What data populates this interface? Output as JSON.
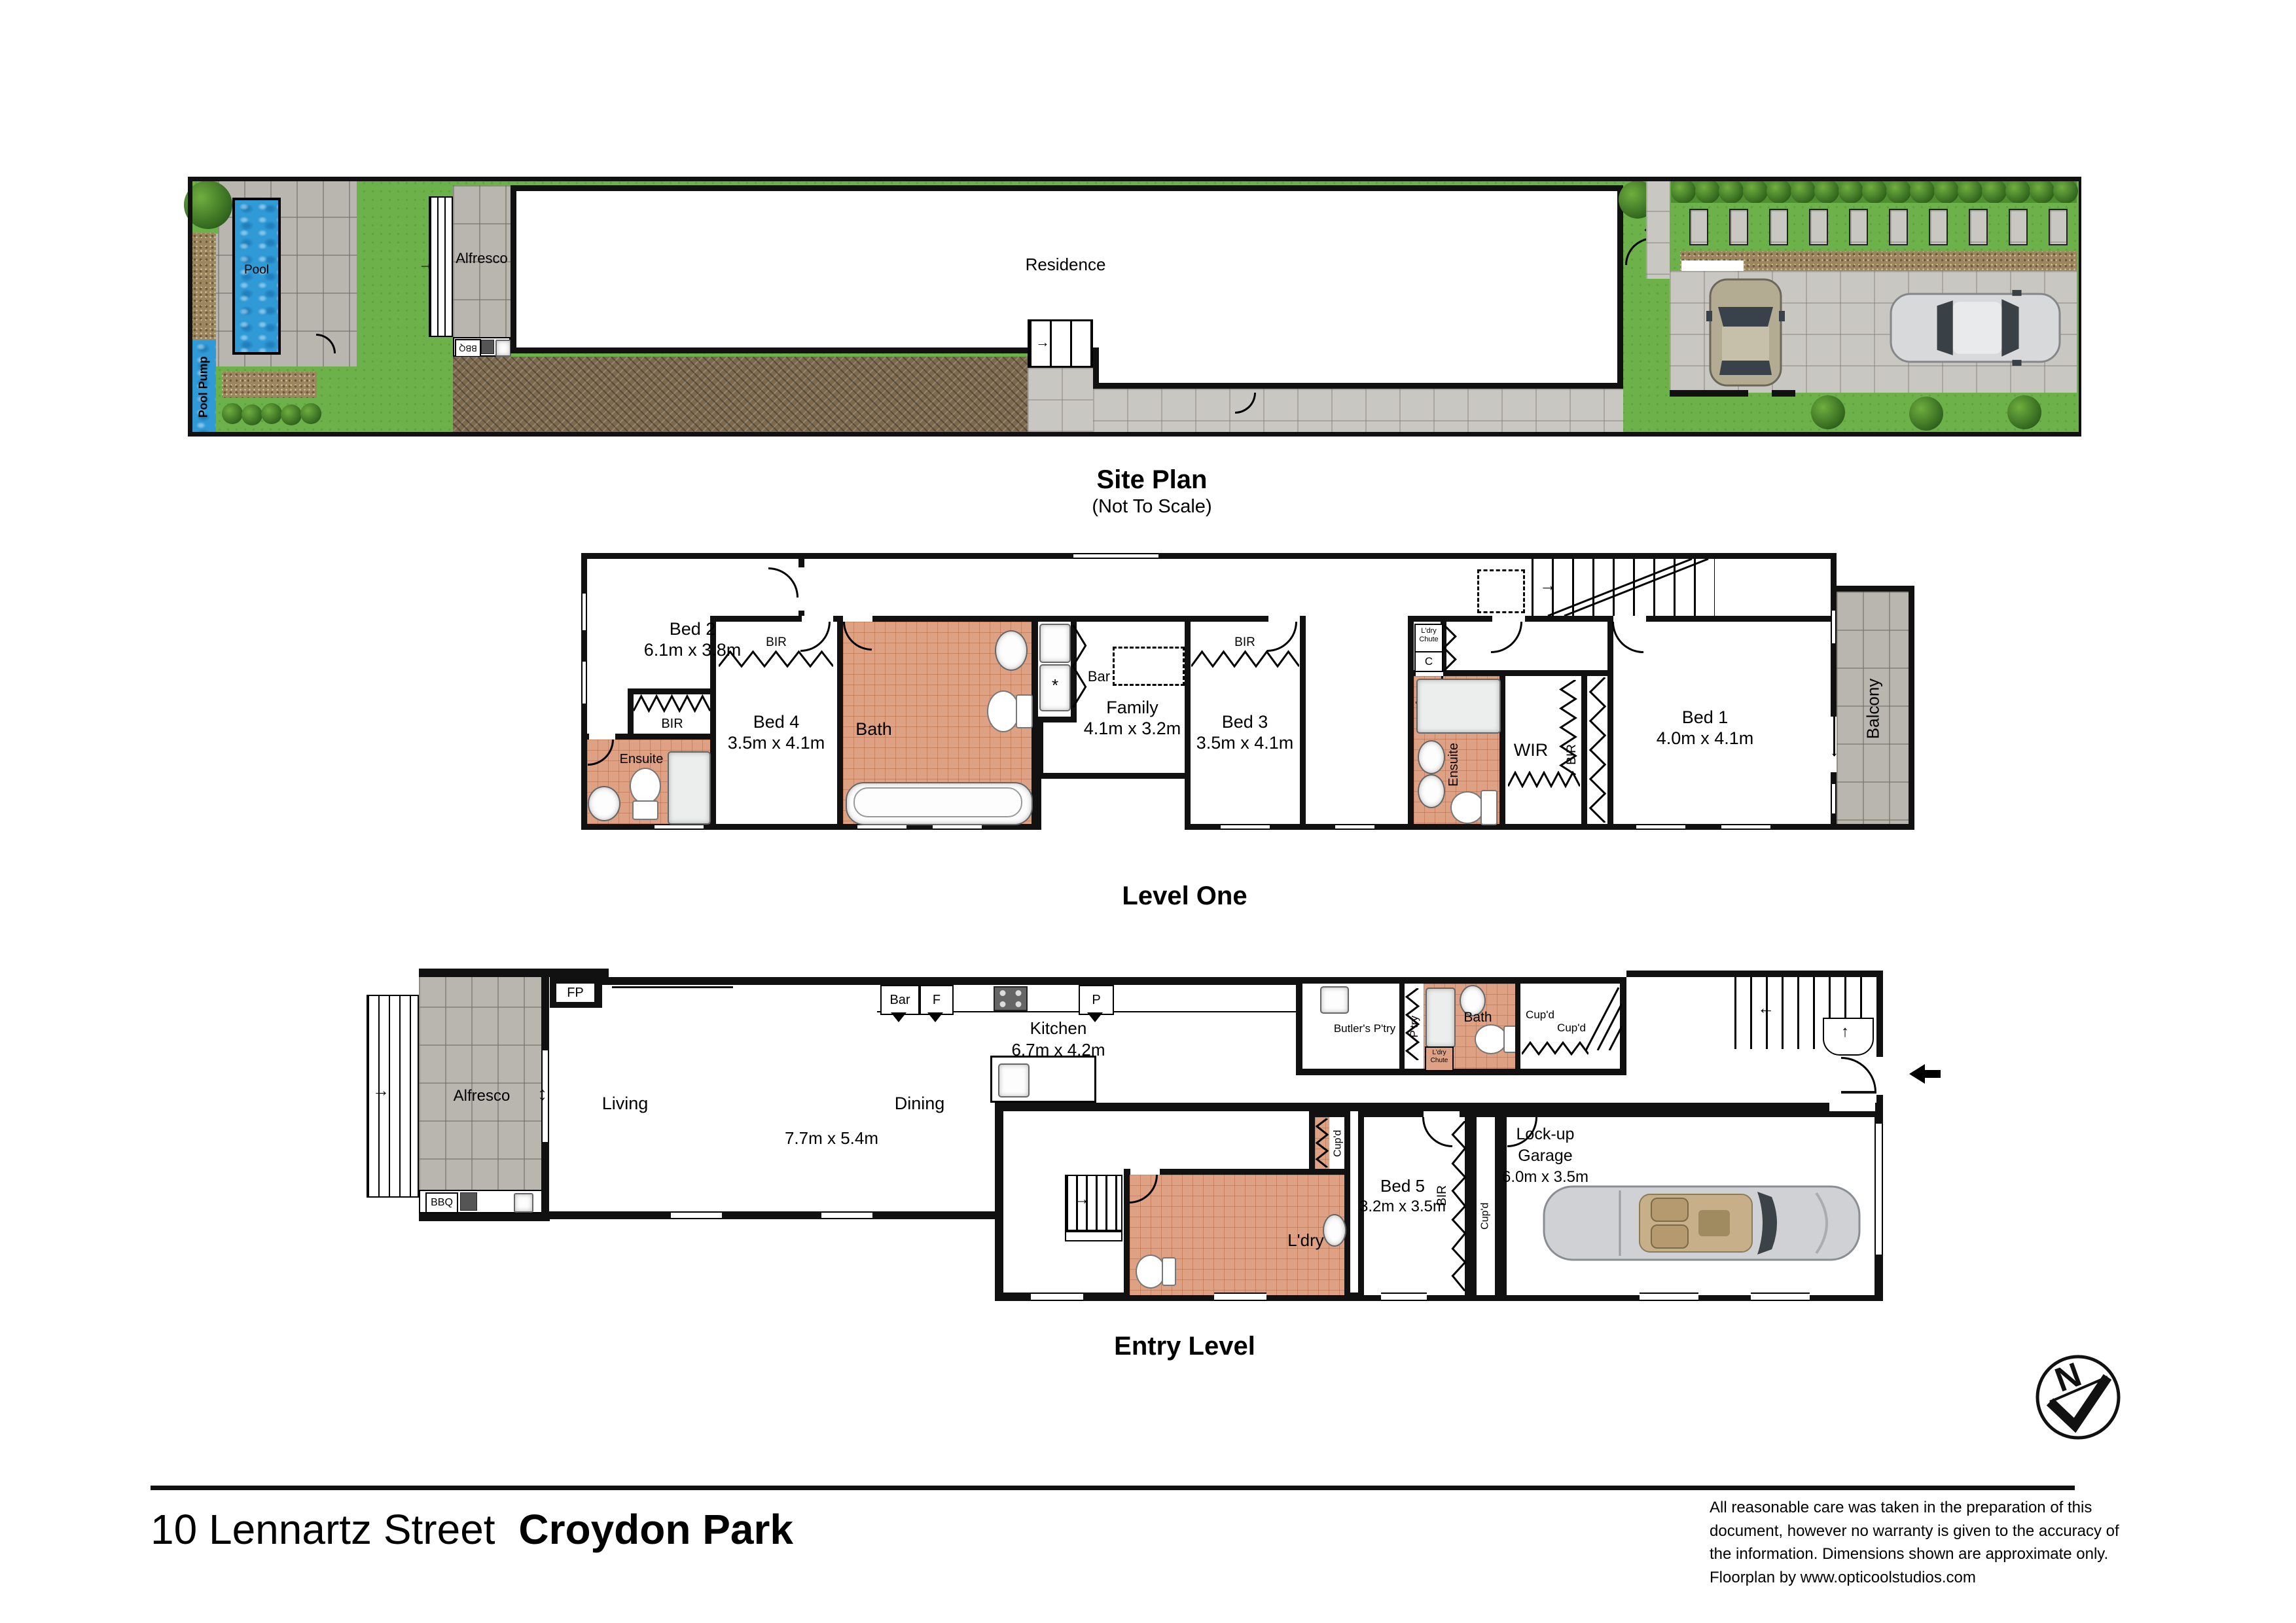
{
  "site": {
    "title": "Site Plan",
    "subtitle": "(Not To Scale)",
    "pool": "Pool",
    "pool_pump": "Pool Pump",
    "alfresco": "Alfresco",
    "bbq": "BBQ",
    "residence": "Residence"
  },
  "l1": {
    "title": "Level One",
    "bed2": {
      "name": "Bed 2",
      "dims": "6.1m x 3.8m"
    },
    "bed4": {
      "name": "Bed 4",
      "dims": "3.5m x 4.1m"
    },
    "bed3": {
      "name": "Bed 3",
      "dims": "3.5m x 4.1m"
    },
    "bed1": {
      "name": "Bed 1",
      "dims": "4.0m x 4.1m"
    },
    "family": {
      "name": "Family",
      "dims": "4.1m x 3.2m"
    },
    "bath": "Bath",
    "bar": "Bar",
    "bir": "BIR",
    "wir": "WIR",
    "ensuite": "Ensuite",
    "ldry_chute": "L'dry Chute",
    "c": "C",
    "balcony": "Balcony"
  },
  "el": {
    "title": "Entry Level",
    "alfresco": "Alfresco",
    "bbq": "BBQ",
    "fp": "FP",
    "living": "Living",
    "dining": "Dining",
    "living_dims": "7.7m x 5.4m",
    "kitchen": {
      "name": "Kitchen",
      "dims": "6.7m x 4.2m"
    },
    "bar": "Bar",
    "f": "F",
    "p": "P",
    "butlers": "Butler's P'try",
    "ptry": "P'try",
    "ldry_chute": "L'dry Chute",
    "bath": "Bath",
    "cupd": "Cup'd",
    "ldry": "L'dry",
    "bed5": {
      "name": "Bed 5",
      "dims": "3.2m x 3.5m"
    },
    "bir": "BIR",
    "garage": {
      "name": "Lock-up Garage",
      "dims": "6.0m x 3.5m"
    }
  },
  "misc": {
    "north": "N",
    "star": "*"
  },
  "footer": {
    "street": "10 Lennartz Street",
    "suburb": "Croydon Park",
    "disclaimer": "All reasonable care was taken in the preparation of this document, however no warranty is given to the accuracy of the information. Dimensions shown are approximate only. Floorplan by www.opticoolstudios.com"
  }
}
